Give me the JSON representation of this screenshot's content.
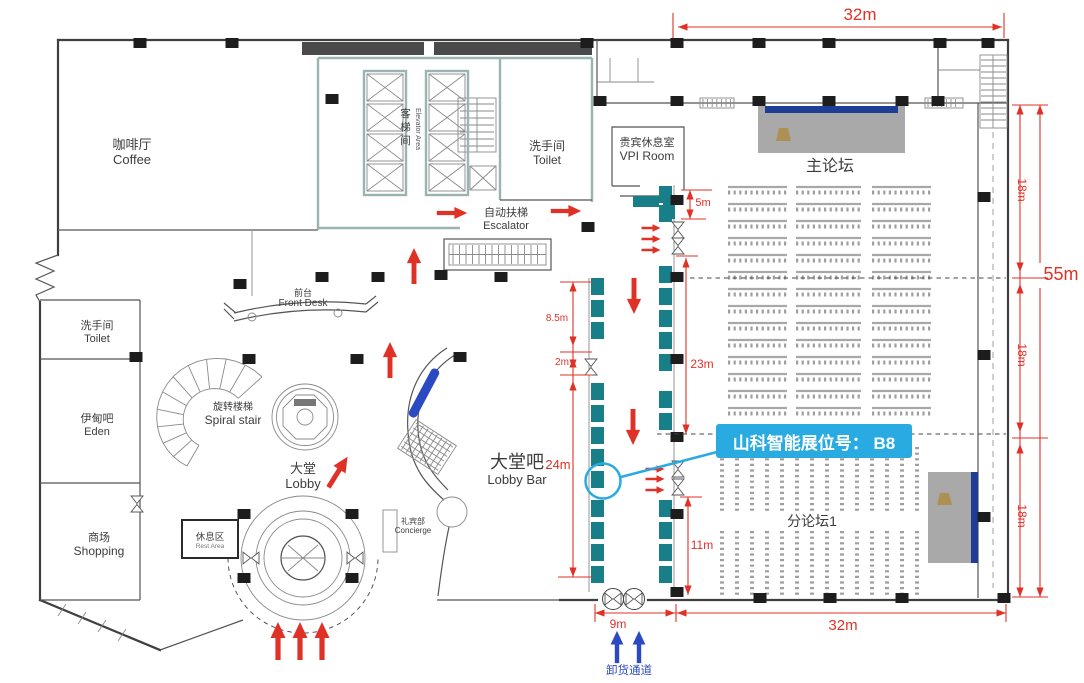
{
  "rooms": {
    "coffee": {
      "zh": "咖啡厅",
      "en": "Coffee"
    },
    "elevator": {
      "zh": "客梯间",
      "en": "Elevator Area"
    },
    "toilet_top": {
      "zh": "洗手间",
      "en": "Toilet"
    },
    "vip_room": {
      "zh": "贵宾休息室",
      "en": "VPI Room"
    },
    "escalator": {
      "zh": "自动扶梯",
      "en": "Escalator"
    },
    "front_desk": {
      "zh": "前台",
      "en": "Front Desk"
    },
    "toilet_left": {
      "zh": "洗手间",
      "en": "Toilet"
    },
    "eden_bar": {
      "zh": "伊甸吧",
      "en": "Eden"
    },
    "spiral_stair": {
      "zh": "旋转楼梯",
      "en": "Spiral stair"
    },
    "lobby": {
      "zh": "大堂",
      "en": "Lobby"
    },
    "shopping": {
      "zh": "商场",
      "en": "Shopping"
    },
    "rest_area": {
      "zh": "休息区",
      "en": "Rest Area"
    },
    "concierge": {
      "zh": "礼宾部",
      "en": "Concierge"
    },
    "lobby_bar": {
      "zh": "大堂吧",
      "en": "Lobby Bar"
    },
    "main_forum": {
      "zh": "主论坛"
    },
    "sub_forum_1": {
      "zh": "分论坛1"
    }
  },
  "dimensions": {
    "hall_width_top": "32m",
    "right_seg_1": "18m",
    "right_seg_2": "18m",
    "right_seg_3": "18m",
    "right_total": "55m",
    "stage_front": "5m",
    "corridor_a": "8.5m",
    "corridor_b": "2m",
    "lobby_bar_length": "24m",
    "forum_side": "23m",
    "subforum_side": "11m",
    "dock_width": "9m",
    "hall_width_bottom": "32m"
  },
  "callout": {
    "booth_label": "山科智能展位号： B8"
  },
  "routes": {
    "unloading_channel": "卸货通道"
  },
  "colors": {
    "dimension_red": "#e03127",
    "booth_teal": "#187f88",
    "callout_blue": "#29abe2",
    "unloading_blue": "#2b49c0",
    "stage_gray": "#a9a9a9",
    "banner_navy": "#1d3e94",
    "wall_teal": "#9ab5b1"
  }
}
